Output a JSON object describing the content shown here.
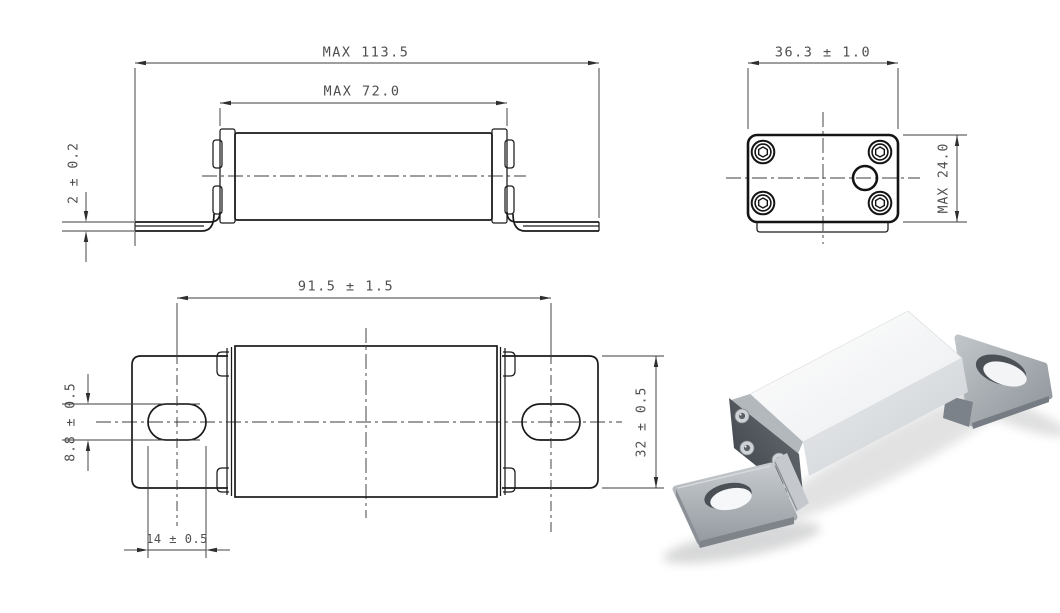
{
  "page": {
    "background": "#ffffff"
  },
  "style": {
    "object_line_color": "#1a1a1a",
    "dimension_line_color": "#3c3c3c",
    "dimension_text_color": "#4f4f4f",
    "render_body_color": "#f7f8f9",
    "render_metal_color": "#a8aeb4",
    "render_end_face_color": "#40454b"
  },
  "views": {
    "front": {
      "dims": {
        "overall_length": "MAX 113.5",
        "body_length": "MAX 72.0",
        "bracket_thickness": "2 ± 0.2"
      }
    },
    "end": {
      "dims": {
        "width": "36.3 ± 1.0",
        "height": "MAX 24.0"
      }
    },
    "top": {
      "dims": {
        "mount_hole_pitch": "91.5 ± 1.5",
        "slot_width": "8.8 ± 0.5",
        "bracket_width": "32 ± 0.5",
        "slot_length": "14 ± 0.5"
      }
    }
  }
}
